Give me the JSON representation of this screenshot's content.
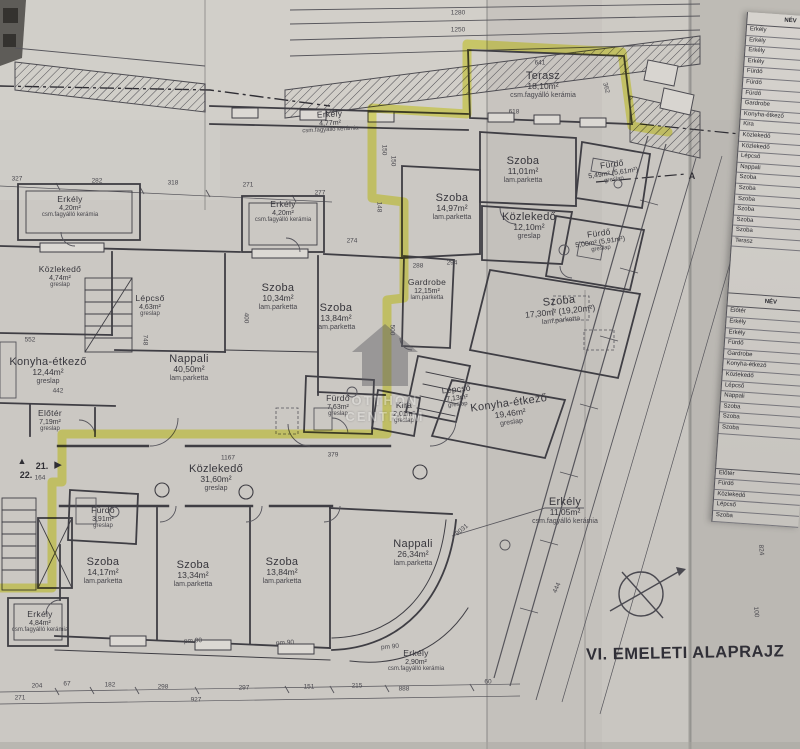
{
  "document": {
    "title": "VI. EMELETI ALAPRAJZ"
  },
  "watermark": {
    "line1": "OTTHON",
    "line2": "CENTRUM"
  },
  "rooms": [
    {
      "name": "Terasz",
      "area": "18,10m²",
      "floor": "csm.fagyálló kerámia",
      "x": 543,
      "y": 85
    },
    {
      "name": "Erkély",
      "area": "4,77m²",
      "floor": "csm.fagyálló kerámia",
      "x": 330,
      "y": 122,
      "rot": -3,
      "small": true
    },
    {
      "name": "Szoba",
      "area": "11,01m²",
      "floor": "lam.parketta",
      "x": 523,
      "y": 170
    },
    {
      "name": "Fürdő",
      "area": "5,49m² (5,61m²)",
      "floor": "greslap",
      "x": 613,
      "y": 172,
      "rot": -8,
      "small": true
    },
    {
      "name": "Szoba",
      "area": "14,97m²",
      "floor": "lam.parketta",
      "x": 452,
      "y": 207
    },
    {
      "name": "Közlekedő",
      "area": "12,10m²",
      "floor": "greslap",
      "x": 529,
      "y": 226
    },
    {
      "name": "Fürdő",
      "area": "5,00m² (5,91m²)",
      "floor": "greslap",
      "x": 600,
      "y": 241,
      "rot": -8,
      "small": true
    },
    {
      "name": "Erkély",
      "area": "4,20m²",
      "floor": "csm.fagyálló kerámia",
      "x": 70,
      "y": 207,
      "small": true
    },
    {
      "name": "Erkély",
      "area": "4,20m²",
      "floor": "csm.fagyálló kerámia",
      "x": 283,
      "y": 212,
      "small": true
    },
    {
      "name": "Közlekedő",
      "area": "4,74m²",
      "floor": "greslap",
      "x": 60,
      "y": 277,
      "small": true
    },
    {
      "name": "Lépcső",
      "area": "4,63m²",
      "floor": "greslap",
      "x": 150,
      "y": 306,
      "small": true
    },
    {
      "name": "Szoba",
      "area": "10,34m²",
      "floor": "lam.parketta",
      "x": 278,
      "y": 297
    },
    {
      "name": "Szoba",
      "area": "13,84m²",
      "floor": "lam.parketta",
      "x": 336,
      "y": 317
    },
    {
      "name": "Gardrobe",
      "area": "12,15m²",
      "floor": "lam.parketta",
      "x": 427,
      "y": 290,
      "small": true
    },
    {
      "name": "Szoba",
      "area": "17,30m² (19,20m²)",
      "floor": "lam.parketta",
      "x": 560,
      "y": 310,
      "rot": -6
    },
    {
      "name": "Konyha-étkező",
      "area": "12,44m²",
      "floor": "greslap",
      "x": 48,
      "y": 371
    },
    {
      "name": "Nappali",
      "area": "40,50m²",
      "floor": "lam.parketta",
      "x": 189,
      "y": 368
    },
    {
      "name": "Előtér",
      "area": "7,19m²",
      "floor": "greslap",
      "x": 50,
      "y": 421,
      "small": true
    },
    {
      "name": "Fürdő",
      "area": "7,63m²",
      "floor": "greslap",
      "x": 338,
      "y": 406,
      "small": true
    },
    {
      "name": "Kira",
      "area": "2,01m²",
      "floor": "greslap",
      "x": 404,
      "y": 413,
      "small": true
    },
    {
      "name": "Lépcső",
      "area": "7,13m²",
      "floor": "greslap",
      "x": 457,
      "y": 397,
      "rot": -6,
      "small": true
    },
    {
      "name": "Konyha-étkező",
      "area": "19,46m²",
      "floor": "greslap",
      "x": 510,
      "y": 412,
      "rot": -8
    },
    {
      "name": "Közlekedő",
      "area": "31,60m²",
      "floor": "greslap",
      "x": 216,
      "y": 478
    },
    {
      "name": "Fürdő",
      "area": "3,91m²",
      "floor": "greslap",
      "x": 103,
      "y": 518,
      "small": true
    },
    {
      "name": "Szoba",
      "area": "14,17m²",
      "floor": "lam.parketta",
      "x": 103,
      "y": 571
    },
    {
      "name": "Szoba",
      "area": "13,34m²",
      "floor": "lam.parketta",
      "x": 193,
      "y": 574
    },
    {
      "name": "Szoba",
      "area": "13,84m²",
      "floor": "lam.parketta",
      "x": 282,
      "y": 571
    },
    {
      "name": "Nappali",
      "area": "26,34m²",
      "floor": "lam.parketta",
      "x": 413,
      "y": 553
    },
    {
      "name": "Erkély",
      "area": "11,05m²",
      "floor": "csm.fagyálló kerámia",
      "x": 565,
      "y": 511
    },
    {
      "name": "Erkély",
      "area": "4,84m²",
      "floor": "csm.fagyálló kerámia",
      "x": 40,
      "y": 622,
      "small": true
    },
    {
      "name": "Erkély",
      "area": "2,90m²",
      "floor": "csm.fagyálló kerámia",
      "x": 416,
      "y": 661,
      "small": true
    }
  ],
  "dims": [
    {
      "t": "1280",
      "x": 458,
      "y": 13
    },
    {
      "t": "1250",
      "x": 458,
      "y": 30
    },
    {
      "t": "327",
      "x": 17,
      "y": 179
    },
    {
      "t": "282",
      "x": 97,
      "y": 181
    },
    {
      "t": "318",
      "x": 173,
      "y": 183
    },
    {
      "t": "271",
      "x": 248,
      "y": 185
    },
    {
      "t": "277",
      "x": 320,
      "y": 193
    },
    {
      "t": "641",
      "x": 540,
      "y": 63
    },
    {
      "t": "618",
      "x": 514,
      "y": 112
    },
    {
      "t": "362",
      "x": 606,
      "y": 88,
      "r": 75
    },
    {
      "t": "150",
      "x": 384,
      "y": 150,
      "r": 90
    },
    {
      "t": "150",
      "x": 393,
      "y": 161,
      "r": 90
    },
    {
      "t": "148",
      "x": 379,
      "y": 207,
      "r": 90
    },
    {
      "t": "294",
      "x": 452,
      "y": 263
    },
    {
      "t": "274",
      "x": 352,
      "y": 241
    },
    {
      "t": "288",
      "x": 418,
      "y": 266
    },
    {
      "t": "400",
      "x": 246,
      "y": 318,
      "r": 90
    },
    {
      "t": "500",
      "x": 392,
      "y": 330,
      "r": 90
    },
    {
      "t": "442",
      "x": 58,
      "y": 391
    },
    {
      "t": "748",
      "x": 145,
      "y": 340,
      "r": 90
    },
    {
      "t": "552",
      "x": 30,
      "y": 340
    },
    {
      "t": "1167",
      "x": 228,
      "y": 458
    },
    {
      "t": "379",
      "x": 333,
      "y": 455
    },
    {
      "t": "164",
      "x": 40,
      "y": 478
    },
    {
      "t": "pm 90",
      "x": 193,
      "y": 641,
      "r": -3
    },
    {
      "t": "pm 90",
      "x": 285,
      "y": 643,
      "r": -3
    },
    {
      "t": "pm 90",
      "x": 390,
      "y": 647,
      "r": -5
    },
    {
      "t": "204",
      "x": 37,
      "y": 686
    },
    {
      "t": "67",
      "x": 67,
      "y": 684
    },
    {
      "t": "182",
      "x": 110,
      "y": 685
    },
    {
      "t": "298",
      "x": 163,
      "y": 687
    },
    {
      "t": "297",
      "x": 244,
      "y": 688
    },
    {
      "t": "151",
      "x": 309,
      "y": 687
    },
    {
      "t": "215",
      "x": 357,
      "y": 686
    },
    {
      "t": "888",
      "x": 404,
      "y": 689
    },
    {
      "t": "60",
      "x": 488,
      "y": 682
    },
    {
      "t": "271",
      "x": 20,
      "y": 698
    },
    {
      "t": "927",
      "x": 196,
      "y": 700
    },
    {
      "t": "1739",
      "x": 737,
      "y": 242,
      "r": 80
    },
    {
      "t": "2461",
      "x": 764,
      "y": 333,
      "r": 85
    },
    {
      "t": "102",
      "x": 757,
      "y": 452,
      "r": 85
    },
    {
      "t": "824",
      "x": 761,
      "y": 550,
      "r": 85
    },
    {
      "t": "100",
      "x": 756,
      "y": 612,
      "r": 85
    },
    {
      "t": "444",
      "x": 557,
      "y": 588,
      "r": -65
    },
    {
      "t": "9031",
      "x": 462,
      "y": 530,
      "r": -40
    }
  ],
  "markers": [
    {
      "t": "▲",
      "x": 22,
      "y": 461
    },
    {
      "t": "21.",
      "x": 42,
      "y": 466
    },
    {
      "t": "▶",
      "x": 58,
      "y": 465
    },
    {
      "t": "22.",
      "x": 26,
      "y": 475
    },
    {
      "t": "A",
      "x": 692,
      "y": 176
    }
  ],
  "legend_table": {
    "header": "NÉV",
    "section1": [
      "Erkély",
      "Erkély",
      "Erkély",
      "Erkély",
      "Fürdő",
      "Fürdő",
      "Fürdő",
      "Gardrobe",
      "Konyha-étkező",
      "Kira",
      "Közlekedő",
      "Közlekedő",
      "Lépcső",
      "Nappali",
      "Szoba",
      "Szoba",
      "Szoba",
      "Szoba",
      "Szoba",
      "Szoba",
      "Terasz"
    ],
    "header2": "NÉV",
    "section2": [
      "Előtér",
      "Erkély",
      "Erkély",
      "Fürdő",
      "Gardrobe",
      "Konyha-étkező",
      "Közlekedő",
      "Lépcső",
      "Nappali",
      "Szoba",
      "Szoba",
      "Szoba"
    ],
    "section3": [
      "Előtér",
      "Fürdő",
      "Közlekedő",
      "Lépcső",
      "Szoba"
    ]
  }
}
